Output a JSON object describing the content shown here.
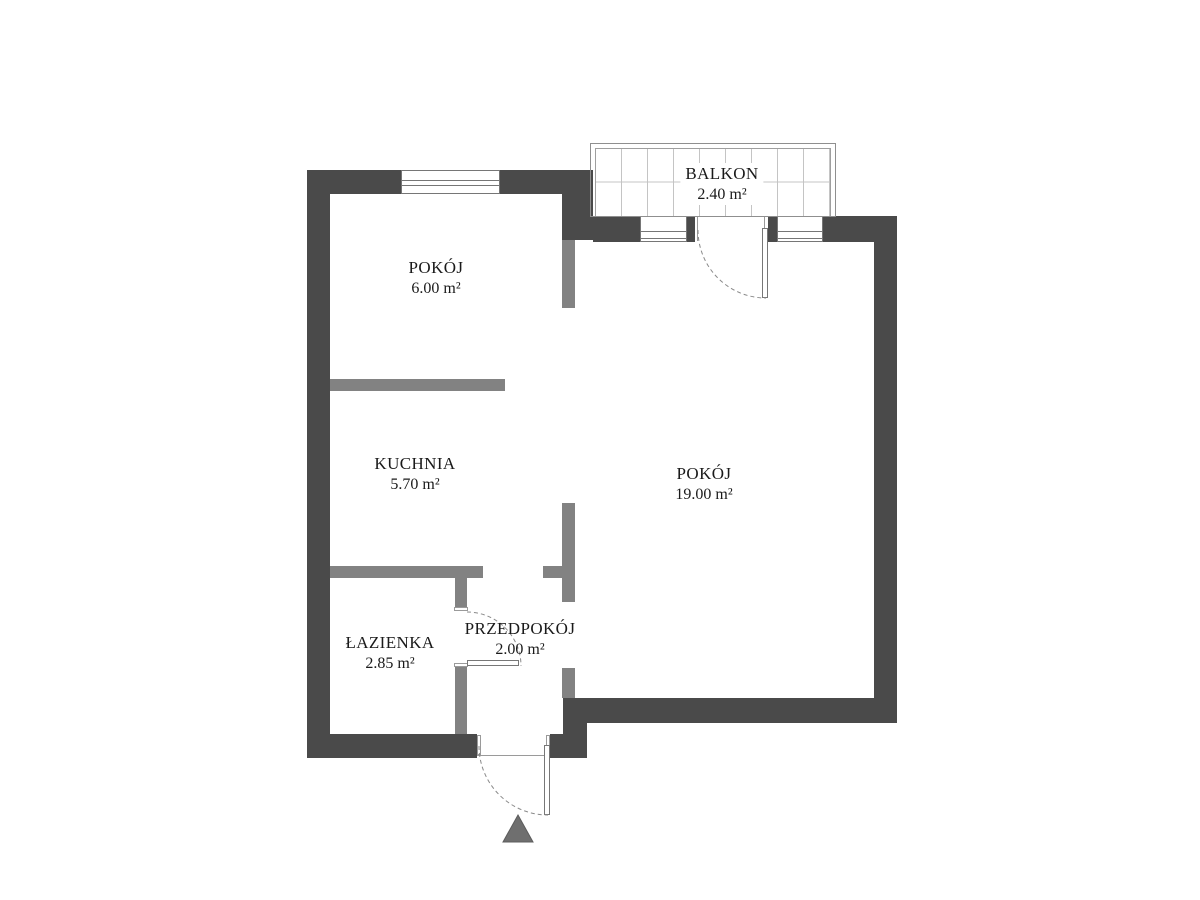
{
  "plan": {
    "title": "Rzut mieszkania",
    "balcony": {
      "label": "BALKON",
      "area": "2.40 m²"
    },
    "rooms": [
      {
        "id": "pokoj-maly",
        "label": "POKÓJ",
        "area": "6.00 m²"
      },
      {
        "id": "kuchnia",
        "label": "KUCHNIA",
        "area": "5.70 m²"
      },
      {
        "id": "pokoj-duzy",
        "label": "POKÓJ",
        "area": "19.00 m²"
      },
      {
        "id": "lazienka",
        "label": "ŁAZIENKA",
        "area": "2.85 m²"
      },
      {
        "id": "przedpokoj",
        "label": "PRZEDPOKÓJ",
        "area": "2.00 m²"
      }
    ],
    "colors": {
      "background": "#ffffff",
      "wall": "#4a4a4a",
      "partition": "#828282",
      "balcony_grid": "#c4c4c4",
      "door_arc": "#8a8a8a",
      "entrance_arrow": "#6f6f6f",
      "text": "#1a1a1a"
    }
  }
}
